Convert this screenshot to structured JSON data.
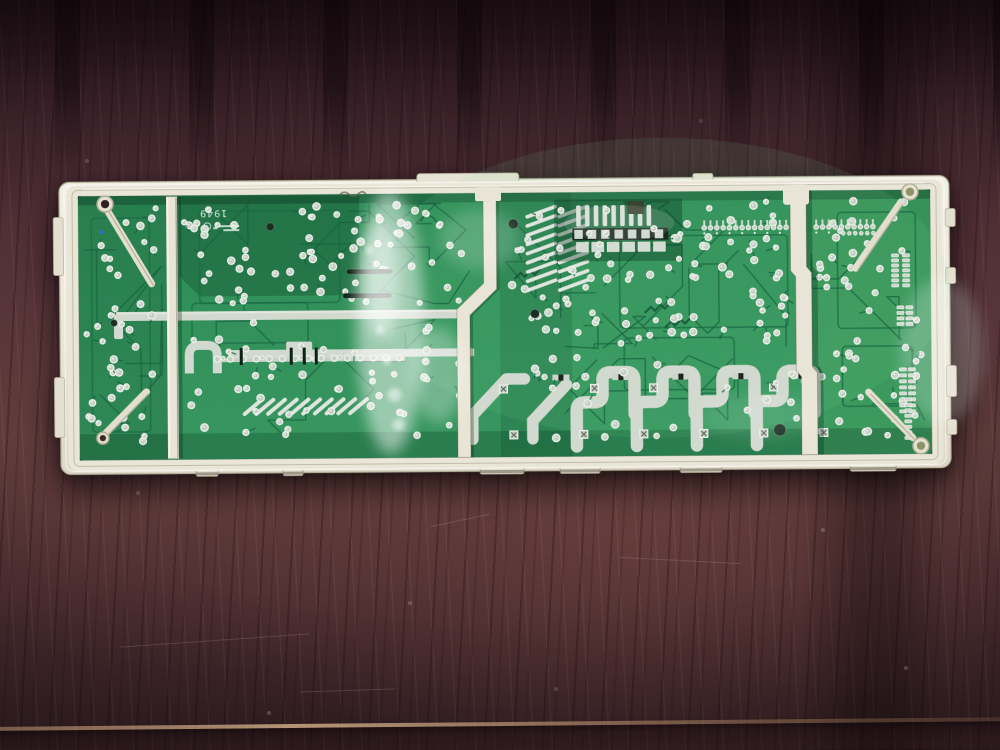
{
  "meta": {
    "description": "Photograph of the solder side of a green appliance control circuit board mounted in a cream plastic frame, lying on a dark mahogany wood table"
  },
  "board": {
    "silkscreen_text": "1949"
  },
  "palette": {
    "frame": "#ebe7d8",
    "frame_hi": "#f8f6ee",
    "frame_shadow": "#b5ae99",
    "frame_line": "#978f78",
    "board_top": "#2e8c56",
    "board_bottom": "#37975f",
    "board_dark": "rgba(4,48,28,0.26)",
    "trace_dark": "#17613f",
    "tinned": "#d2d9cf",
    "tinned_hi": "#eef2ea",
    "solder": "#c6cfc6",
    "solder_ring": "#ecf2e8",
    "slot_black": "#0d2015",
    "olive": "#8f9266",
    "hole_dark": "#30211f",
    "blue_dot": "#3a6acc",
    "glare": "#ffffff"
  },
  "paint": {
    "seed": 20240917,
    "scatter_regions": [
      {
        "x": 26,
        "y": 26,
        "w": 76,
        "h": 236,
        "count": 38,
        "traces": 4
      },
      {
        "x": 124,
        "y": 24,
        "w": 286,
        "h": 100,
        "count": 72,
        "traces": 8
      },
      {
        "x": 124,
        "y": 140,
        "w": 286,
        "h": 118,
        "count": 46,
        "traces": 5
      },
      {
        "x": 446,
        "y": 24,
        "w": 280,
        "h": 146,
        "count": 92,
        "traces": 10
      },
      {
        "x": 446,
        "y": 178,
        "w": 310,
        "h": 82,
        "count": 26,
        "traces": 4
      },
      {
        "x": 752,
        "y": 24,
        "w": 112,
        "h": 236,
        "count": 46,
        "traces": 5
      }
    ],
    "pin_row_a": {
      "x": 645,
      "y": 46,
      "n": 14,
      "dx": 6.3
    },
    "pin_row_b": {
      "x": 757,
      "y": 46,
      "n": 10,
      "dx": 6.3
    },
    "pin_row_b2": {
      "x": 784,
      "y": 57,
      "n": 6,
      "dx": 6.0
    },
    "mid_row": {
      "x": 157,
      "y": 178,
      "n": 15,
      "dx": 13
    },
    "mid_row_slots": [
      181,
      231,
      244,
      256
    ],
    "right_strips": [
      {
        "x": 832,
        "y": 78,
        "rows": 7,
        "dy": 5,
        "cols": 2,
        "dxc": 11
      },
      {
        "x": 837,
        "y": 130,
        "rows": 4,
        "dy": 5.5,
        "cols": 2,
        "dxc": 9
      },
      {
        "x": 839,
        "y": 192,
        "rows": 8,
        "dy": 6,
        "cols": 2,
        "dxc": 9
      },
      {
        "x": 844,
        "y": 222,
        "rows": 8,
        "dy": 5.5,
        "cols": 1,
        "dxc": 0
      }
    ],
    "smd_block": {
      "x": 495,
      "y": 21,
      "vpads": 9,
      "sqpads": 7,
      "bigpads": 6
    },
    "hatch_a_cols": [
      468,
      500
    ],
    "hatch_b": {
      "x": 184,
      "y": 233,
      "n": 10,
      "dx": 11.7
    },
    "loops_cx": [
      546,
      606,
      666,
      726
    ],
    "via_squares": [
      [
        439,
        206
      ],
      [
        449,
        252
      ],
      [
        519,
        252
      ],
      [
        530,
        206
      ],
      [
        589,
        206
      ],
      [
        579,
        252
      ],
      [
        639,
        252
      ],
      [
        699,
        252
      ],
      [
        709,
        206
      ],
      [
        759,
        252
      ]
    ],
    "pad_pairs": [
      [
        500,
        196
      ],
      [
        560,
        196
      ],
      [
        620,
        196
      ],
      [
        680,
        196
      ],
      [
        740,
        196
      ]
    ],
    "feet": [
      {
        "x": 135,
        "w": 22
      },
      {
        "x": 222,
        "w": 20
      },
      {
        "x": 419,
        "w": 44
      },
      {
        "x": 499,
        "w": 40
      },
      {
        "x": 619,
        "w": 42
      },
      {
        "x": 789,
        "w": 46
      }
    ],
    "left_tabs": [
      {
        "y": 35,
        "h": 58
      },
      {
        "y": 195,
        "h": 60
      }
    ],
    "right_tabs": [
      {
        "y": 33,
        "h": 18
      },
      {
        "y": 92,
        "h": 16
      },
      {
        "y": 190,
        "h": 31
      },
      {
        "y": 244,
        "h": 15
      }
    ],
    "black_holes": [
      [
        211,
        46,
        4
      ],
      [
        454,
        45,
        5
      ],
      [
        475,
        135,
        4.5
      ],
      [
        719,
        253,
        6
      ],
      [
        54,
        141,
        3.5
      ]
    ],
    "slot_pair": [
      [
        287,
        89,
        46
      ],
      [
        283,
        113,
        49
      ]
    ]
  }
}
